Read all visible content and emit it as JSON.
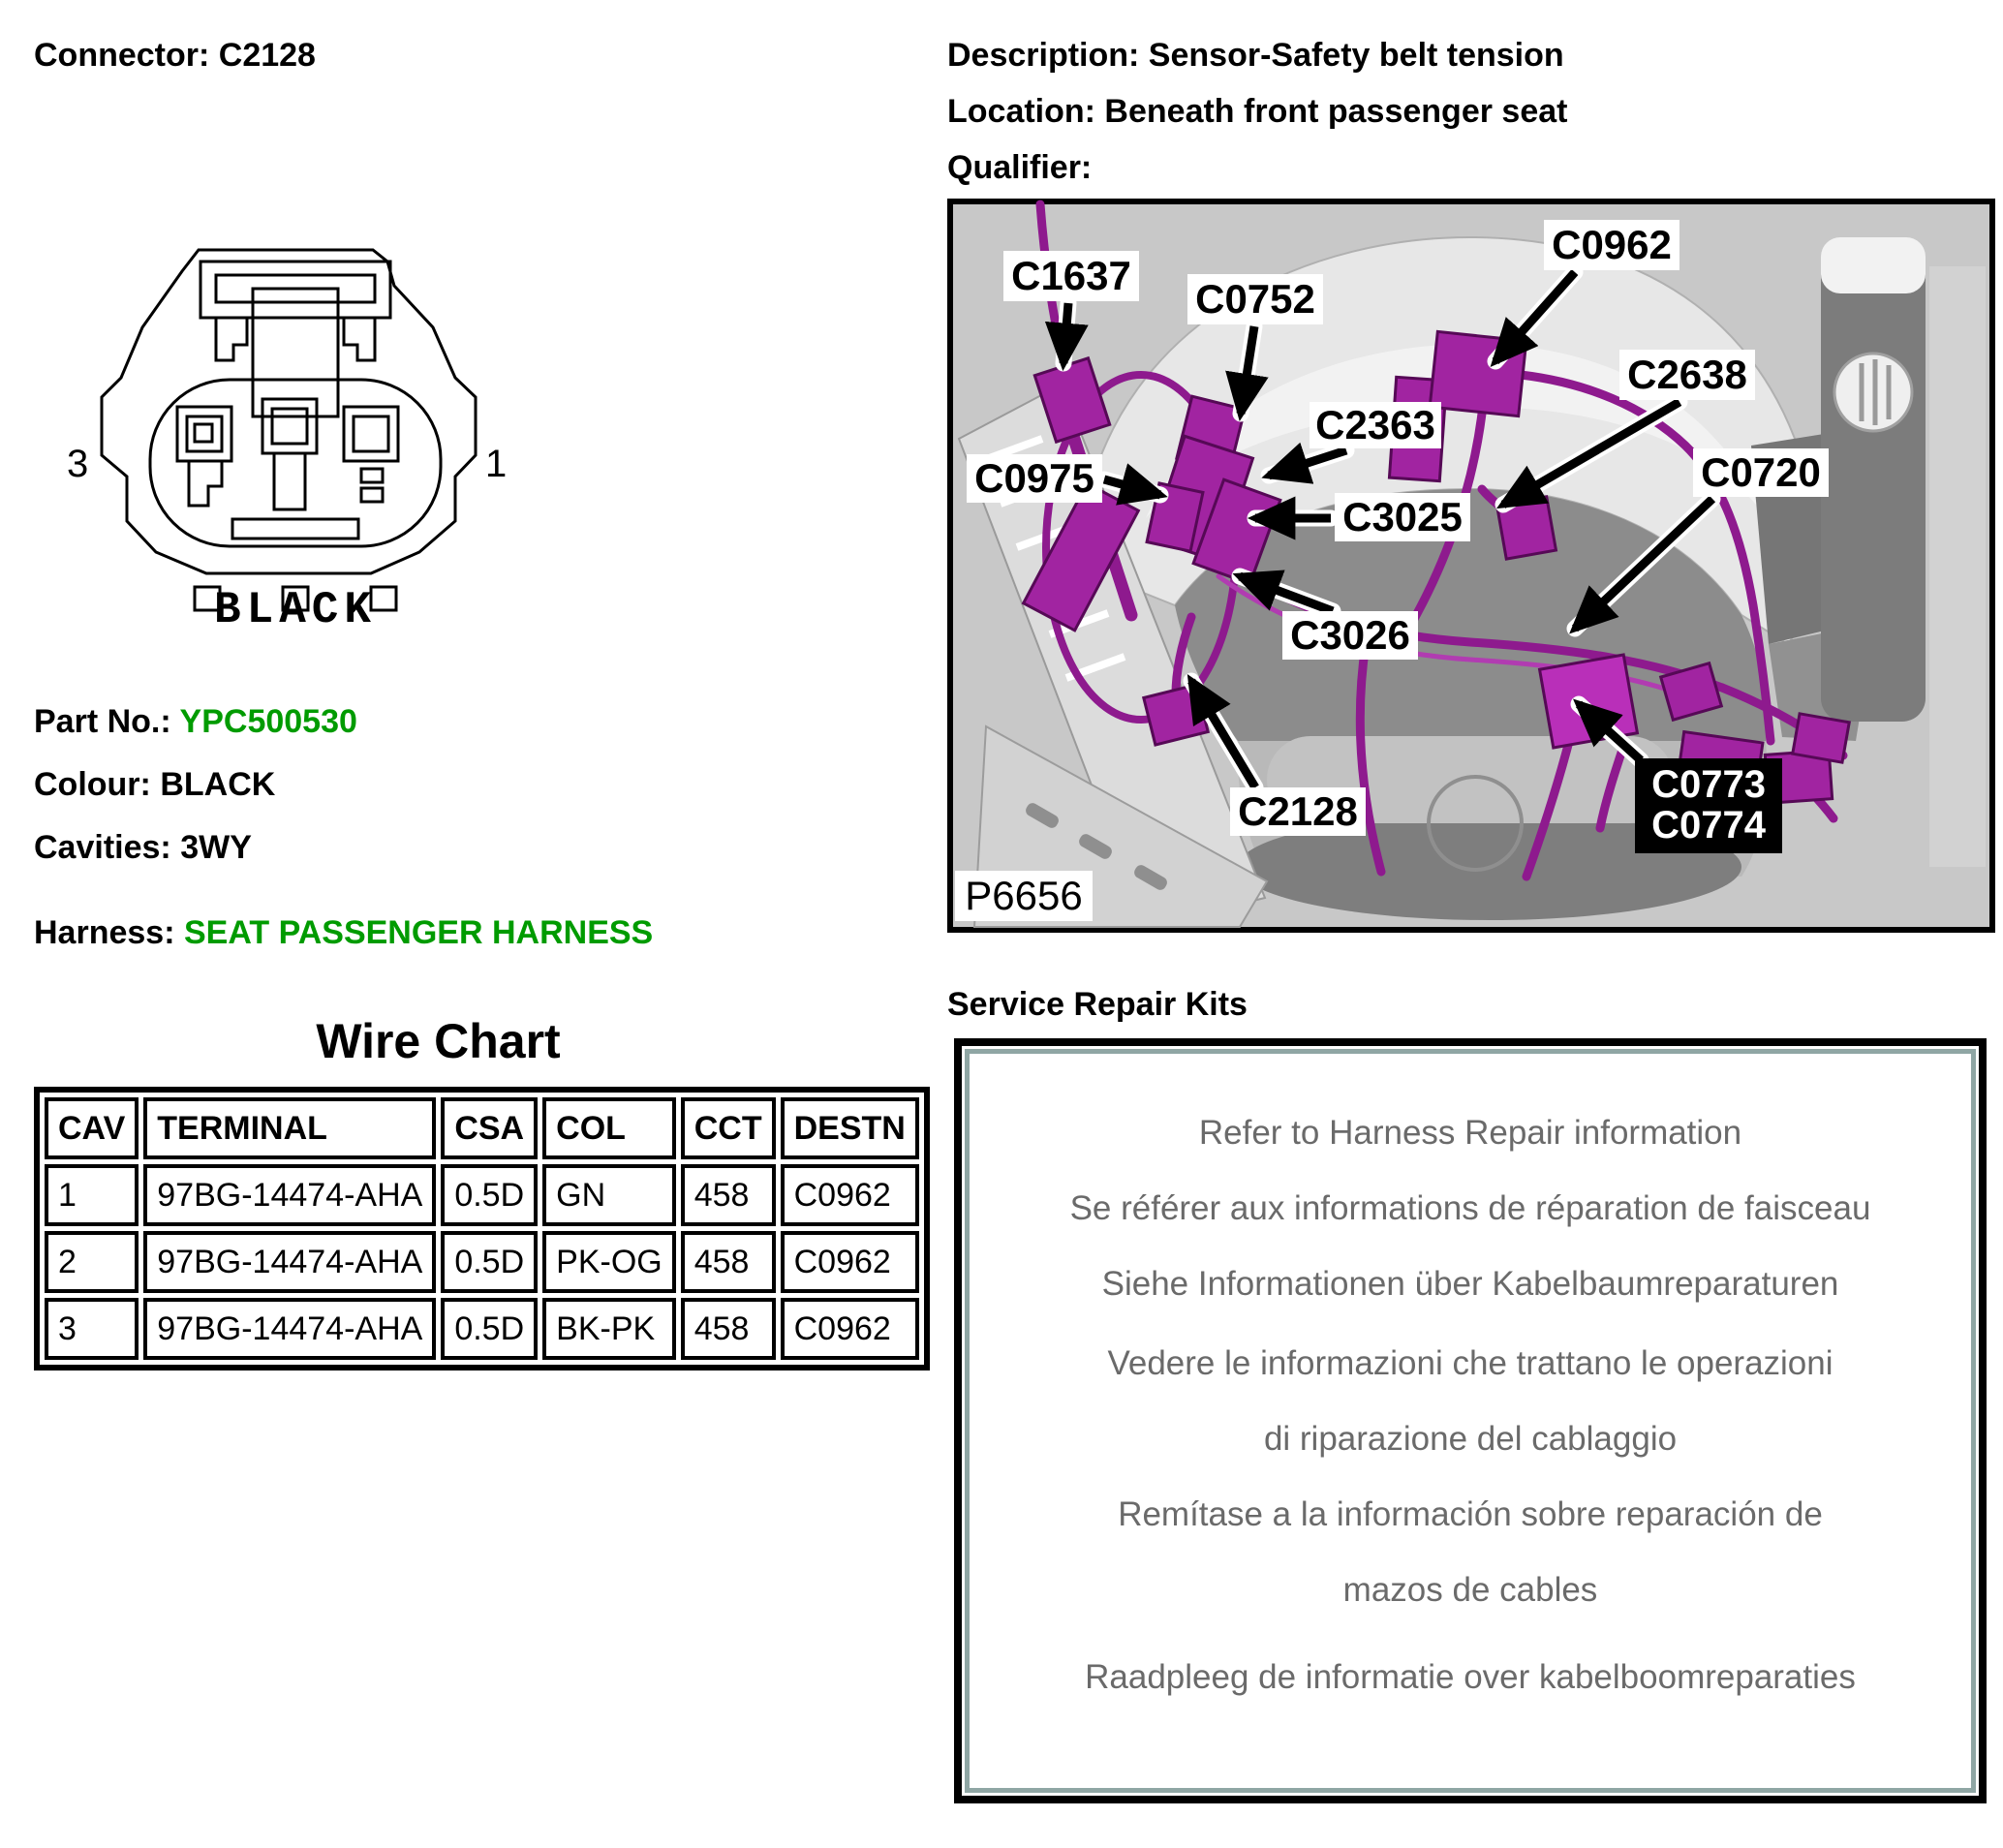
{
  "header": {
    "connector": "Connector: C2128",
    "description": "Description: Sensor-Safety belt tension",
    "location": "Location: Beneath front passenger seat",
    "qualifier": "Qualifier:"
  },
  "connector_drawing": {
    "pin_left": "3",
    "pin_right": "1",
    "colour_caption": "BLACK"
  },
  "part_info": {
    "part_no_label": "Part No.:",
    "part_no_value": "YPC500530",
    "colour_label": "Colour:",
    "colour_value": "BLACK",
    "cavities_label": "Cavities:",
    "cavities_value": "3WY",
    "harness_label": "Harness:",
    "harness_value": "SEAT PASSENGER HARNESS"
  },
  "wire_chart": {
    "title": "Wire Chart",
    "columns": [
      "CAV",
      "TERMINAL",
      "CSA",
      "COL",
      "CCT",
      "DESTN"
    ],
    "rows": [
      [
        "1",
        "97BG-14474-AHA",
        "0.5D",
        "GN",
        "458",
        "C0962"
      ],
      [
        "2",
        "97BG-14474-AHA",
        "0.5D",
        "PK-OG",
        "458",
        "C0962"
      ],
      [
        "3",
        "97BG-14474-AHA",
        "0.5D",
        "BK-PK",
        "458",
        "C0962"
      ]
    ]
  },
  "photo": {
    "callouts": [
      "C1637",
      "C0752",
      "C0962",
      "C2638",
      "C2363",
      "C0975",
      "C3025",
      "C0720",
      "C3026",
      "C2128"
    ],
    "black_label_line1": "C0773",
    "black_label_line2": "C0774",
    "figure_id": "P6656"
  },
  "service_repair": {
    "heading": "Service Repair Kits",
    "lines": [
      "Refer to Harness Repair information",
      "Se référer aux informations de réparation de faisceau",
      "Siehe Informationen über Kabelbaumreparaturen",
      "Vedere le informazioni che trattano le operazioni",
      "di riparazione del cablaggio",
      "Remítase a la información sobre reparación de",
      "mazos de cables",
      "Raadpleeg de informatie over kabelboomreparaties"
    ]
  },
  "colors": {
    "accent_green": "#009B00",
    "harness_purple": "#A124A1",
    "photo_background_gray": "#C8C8C8",
    "repair_box_inner_border": "#8FA6A4",
    "repair_text_gray": "#6A6A6A"
  }
}
